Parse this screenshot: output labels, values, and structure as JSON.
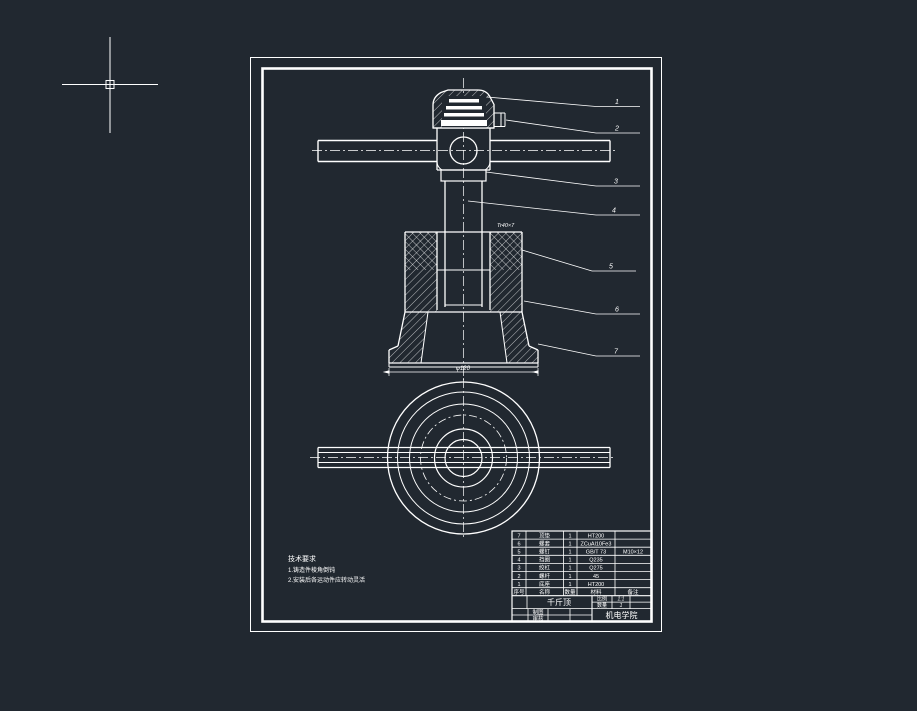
{
  "app": {
    "background_color": "#212830",
    "line_color": "#ffffff",
    "cursor": "crosshair"
  },
  "drawing": {
    "balloons": [
      "1",
      "2",
      "3",
      "4",
      "5",
      "6",
      "7"
    ],
    "dimensions": {
      "base_diameter": "φ120",
      "thread_callout": "Tr40×7"
    },
    "notes": {
      "title": "技术要求",
      "items": [
        "1.铸造件棱角倒钝",
        "2.安装后各运动件应转动灵活"
      ]
    },
    "bom": {
      "headers": {
        "no": "序号",
        "name": "名称",
        "qty": "数量",
        "material": "材料",
        "remark": "备注"
      },
      "rows": [
        {
          "no": "7",
          "name": "顶垫",
          "qty": "1",
          "material": "HT200",
          "remark": ""
        },
        {
          "no": "6",
          "name": "螺套",
          "qty": "1",
          "material": "ZCuAl10Fe3",
          "remark": ""
        },
        {
          "no": "5",
          "name": "螺钉",
          "qty": "1",
          "material": "GB/T 73",
          "remark": "M10×12"
        },
        {
          "no": "4",
          "name": "挡圈",
          "qty": "1",
          "material": "Q235",
          "remark": ""
        },
        {
          "no": "3",
          "name": "绞杠",
          "qty": "1",
          "material": "Q275",
          "remark": ""
        },
        {
          "no": "2",
          "name": "螺杆",
          "qty": "1",
          "material": "45",
          "remark": ""
        },
        {
          "no": "1",
          "name": "底座",
          "qty": "1",
          "material": "HT200",
          "remark": ""
        }
      ]
    },
    "title_block": {
      "part_title": "千斤顶",
      "scale_label": "比例",
      "scale_value": "1:1",
      "qty_label": "数量",
      "qty_value": "1",
      "drawn_label": "制图",
      "checked_label": "审核",
      "org": "机电学院"
    }
  }
}
